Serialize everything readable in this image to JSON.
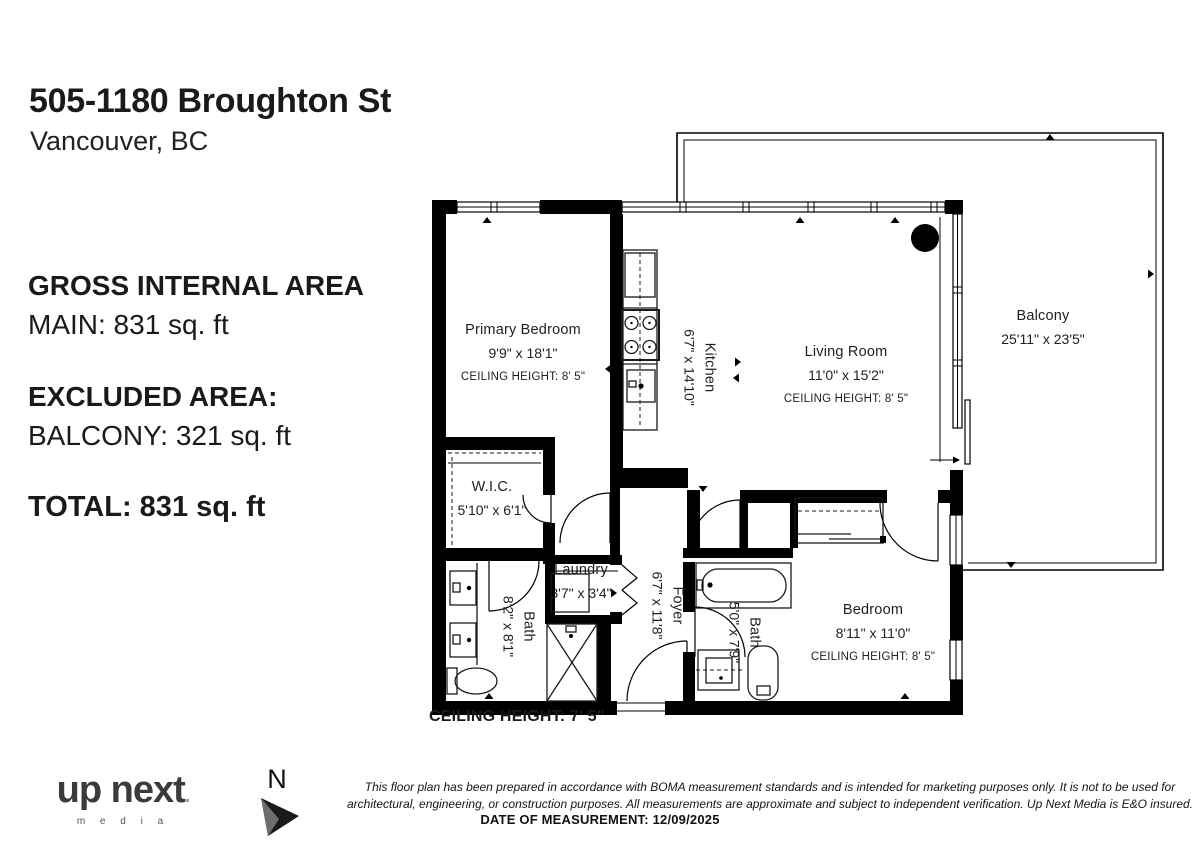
{
  "header": {
    "title": "505-1180 Broughton St",
    "subtitle": "Vancouver, BC"
  },
  "area_summary": {
    "gross_label": "GROSS INTERNAL AREA",
    "main_line": "MAIN: 831 sq. ft",
    "excluded_label": "EXCLUDED AREA:",
    "balcony_line": "BALCONY: 321 sq. ft",
    "total_line": "TOTAL: 831 sq. ft"
  },
  "floorplan": {
    "rooms": {
      "primary_bedroom": {
        "name": "Primary Bedroom",
        "dims": "9'9\" x 18'1\"",
        "ceiling": "CEILING HEIGHT: 8' 5\""
      },
      "kitchen": {
        "name": "Kitchen",
        "dims": "6'7\" x 14'10\""
      },
      "living_room": {
        "name": "Living Room",
        "dims": "11'0\" x 15'2\"",
        "ceiling": "CEILING HEIGHT: 8' 5\""
      },
      "balcony": {
        "name": "Balcony",
        "dims": "25'11\" x 23'5\""
      },
      "wic": {
        "name": "W.I.C.",
        "dims": "5'10\" x 6'1\""
      },
      "laundry": {
        "name": "Laundry",
        "dims": "3'7\" x 3'4\""
      },
      "bath_main": {
        "name": "Bath",
        "dims": "8'2\" x 8'1\""
      },
      "foyer": {
        "name": "Foyer",
        "dims": "6'7\" x 11'8\""
      },
      "bath_second": {
        "name": "Bath",
        "dims": "5'0\" x 7'9\""
      },
      "bedroom": {
        "name": "Bedroom",
        "dims": "8'11\" x 11'0\"",
        "ceiling": "CEILING HEIGHT: 8' 5\""
      }
    },
    "floor_ceiling_note": "CEILING HEIGHT: 7' 5\""
  },
  "footer": {
    "logo": {
      "word1": "up",
      "word2": "next",
      "sub": "m e d i a"
    },
    "north_label": "N",
    "disclaimer_line1": "This floor plan has been prepared in accordance with BOMA measurement standards and is intended for marketing purposes only. It is not to be used for",
    "disclaimer_line2": "architectural, engineering, or construction purposes. All measurements are approximate and subject to independent verification. Up Next Media is E&O insured.",
    "date_line": "DATE OF MEASUREMENT: 12/09/2025"
  },
  "colors": {
    "wall": "#000000",
    "text": "#1f1f1f",
    "logo_gray": "#3b3b3b"
  }
}
